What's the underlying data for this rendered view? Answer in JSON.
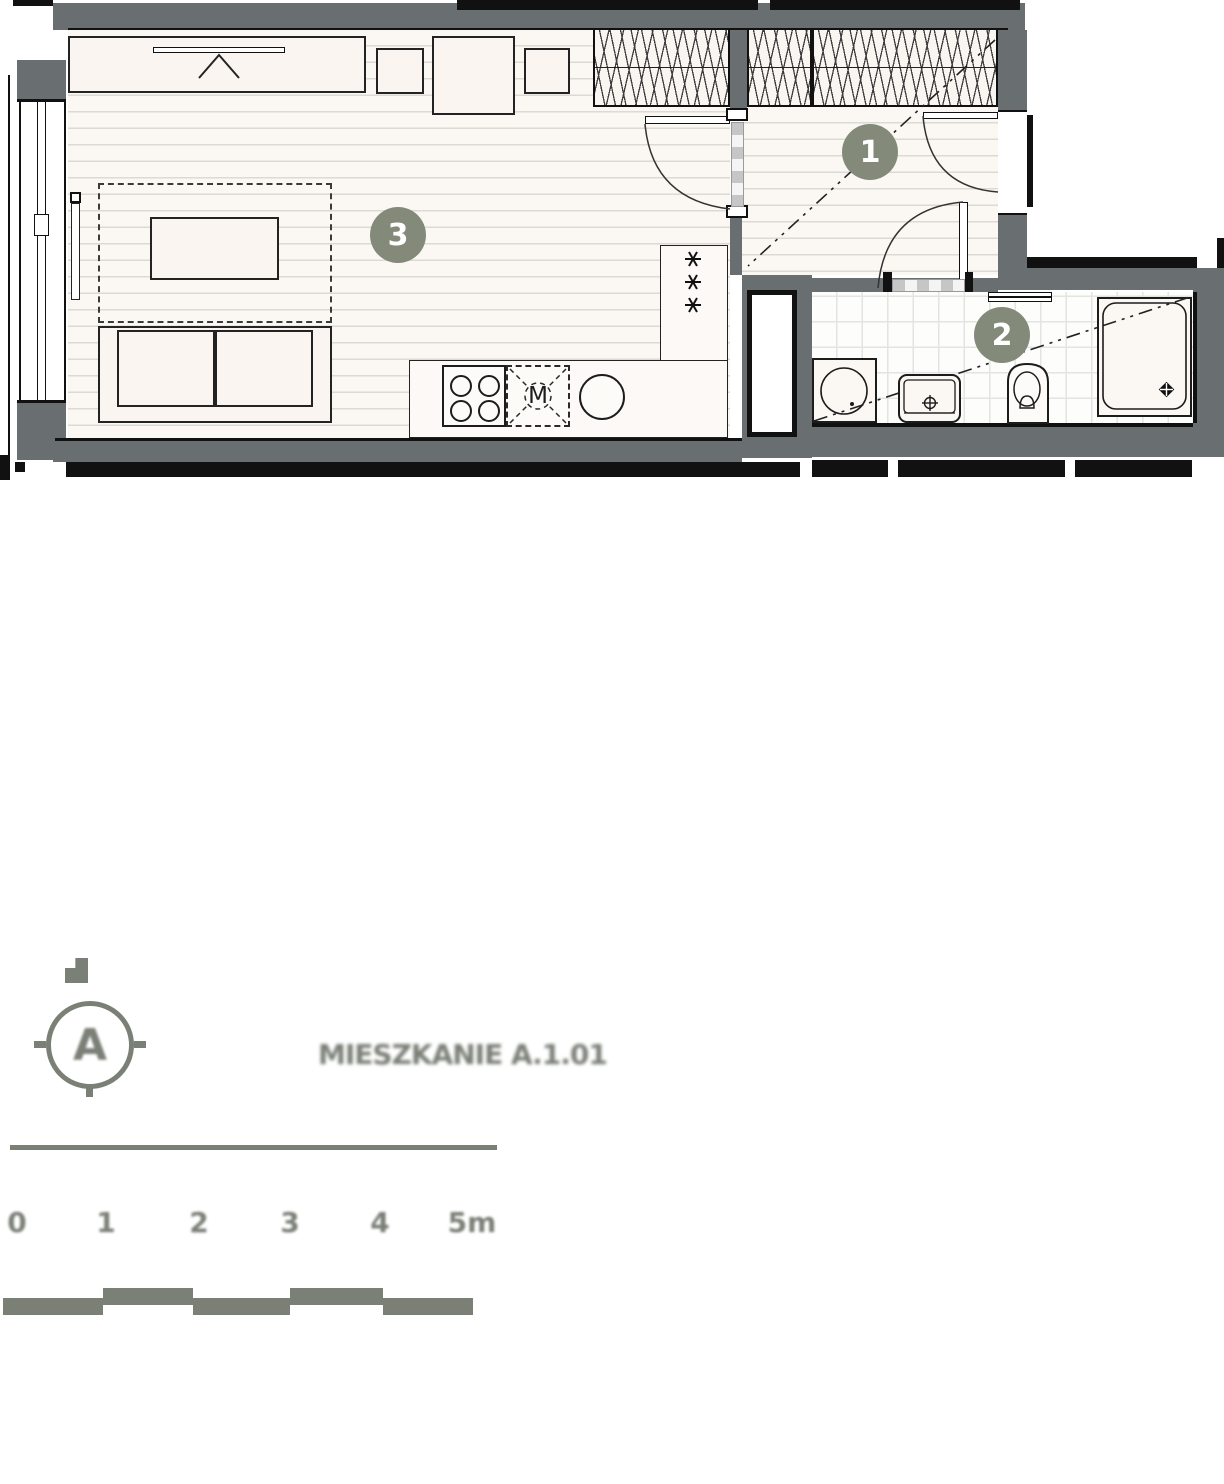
{
  "plan": {
    "room_markers": [
      {
        "number": "1"
      },
      {
        "number": "2"
      },
      {
        "number": "3"
      }
    ],
    "kitchen": {
      "meter_label": "M"
    },
    "marker_color": "#848a7a"
  },
  "footer": {
    "compass": {
      "letter": "A"
    },
    "unit_title": "MIESZKANIE A.1.01",
    "scale_bar": {
      "labels": [
        "0",
        "1",
        "2",
        "3",
        "4",
        "5m"
      ]
    },
    "accent_color": "#7b8077"
  },
  "colors": {
    "wall_fill": "#696e70",
    "outline": "#111111",
    "floor": "#fbf8f4",
    "furniture": "#faf5f0"
  }
}
